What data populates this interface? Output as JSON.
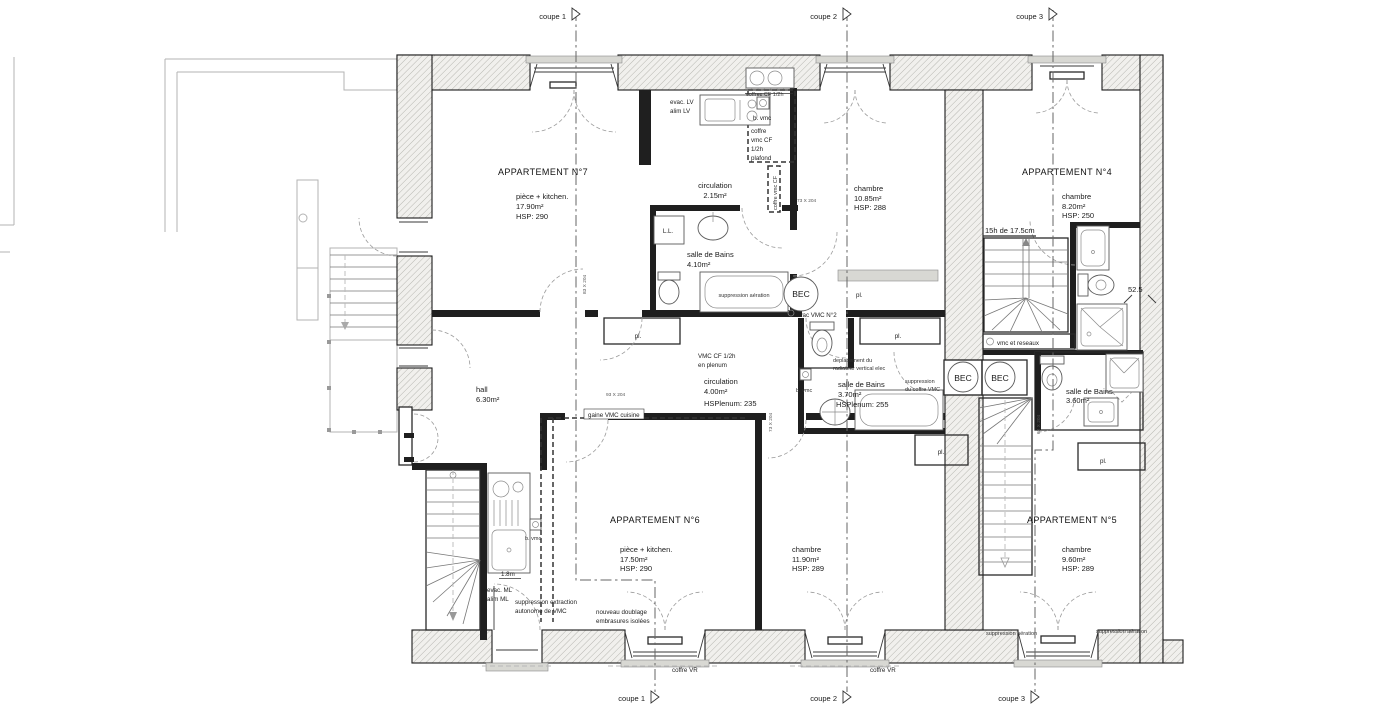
{
  "meta": {
    "drawing_type": "architectural floor plan"
  },
  "coupes": {
    "c1": "coupe 1",
    "c2": "coupe 2",
    "c3": "coupe 3"
  },
  "apt7": {
    "title": "APPARTEMENT N°7",
    "room": "pièce + kitchen.",
    "room_area": "17.90m²",
    "room_hsp": "HSP: 290",
    "evac_lv": "evac. LV",
    "alim_lv": "alim LV",
    "b_vmc": "b. vmc",
    "coffre1": "coffre",
    "coffre2": "vmc CF",
    "coffre3": "1/2h",
    "coffre4": "plafond",
    "coffre_top": "coffres CF 1/2h",
    "coffre_vert": "coffre vmc CF",
    "circulation": "circulation",
    "circulation_area": "2.15m²",
    "ll": "L.L.",
    "bains": "salle de Bains",
    "bains_area": "4.10m²",
    "suppression": "suppression aération",
    "bec": "BEC",
    "evac_vmc": "evac VMC N°2",
    "pl": "pl.",
    "chambre": "chambre",
    "chambre_area": "10.85m²",
    "chambre_hsp": "HSP: 288",
    "dim_a": "73 X 204",
    "dim_b": "83 X 204"
  },
  "apt4": {
    "title": "APPARTEMENT N°4",
    "chambre": "chambre",
    "chambre_area": "8.20m²",
    "chambre_hsp": "HSP: 250",
    "stair_note": "15h de 17.5cm",
    "dim": "52.5",
    "vmc_strip": "vmc et reseaux"
  },
  "middle": {
    "hall": "hall",
    "hall_area": "6.30m²",
    "pl_a": "pl.",
    "pl_b": "pl.",
    "pl_c": "pl.",
    "vmc_cf": "VMC CF 1/2h",
    "en_plenum": "en plenum",
    "circulation": "circulation",
    "circulation_area": "4.00m²",
    "circulation_hsp": "HSPlenum: 235",
    "b_vmc": "b. vmc",
    "bains": "salle de Bains",
    "bains_area": "3.70m²",
    "bains_hsp": "HSPlenum: 255",
    "depl1": "deplacement du",
    "depl2": "radiateur vertical elec",
    "suppr1": "suppression",
    "suppr2": "du coffre VMC",
    "bec1": "BEC",
    "bec2": "BEC",
    "gaine": "gaine VMC cuisine",
    "dim_a": "93 X 204",
    "dim_b": "73 X 204"
  },
  "apt6": {
    "title": "APPARTEMENT N°6",
    "room": "pièce + kitchen.",
    "room_area": "17.50m²",
    "room_hsp": "HSP: 290",
    "b_vmc": "b. vmc",
    "dim18": "1.8m",
    "evac_ml": "evac. ML",
    "alim_ml": "alim ML",
    "suppr1": "suppression extraction",
    "suppr2": "autonome de VMC",
    "doubl1": "nouveau doublage",
    "doubl2": "embrasures isolées",
    "chambre": "chambre",
    "chambre_area": "11.90m²",
    "chambre_hsp": "HSP: 289",
    "coffre_vr1": "coffre VR",
    "coffre_vr2": "coffre VR"
  },
  "apt5": {
    "title": "APPARTEMENT N°5",
    "chambre": "chambre",
    "chambre_area": "9.60m²",
    "chambre_hsp": "HSP: 289",
    "bains": "salle de Bains",
    "bains_area": "3.60m²",
    "pl": "pl.",
    "suppr1": "suppression aération",
    "suppr2": "suppression aération",
    "dim62": "62 X 204"
  }
}
